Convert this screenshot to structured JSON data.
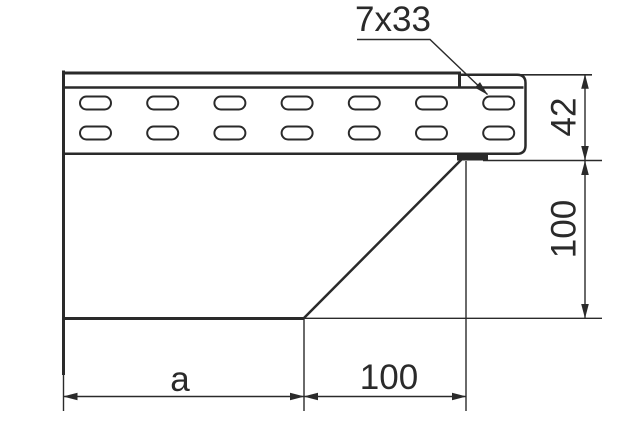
{
  "drawing": {
    "callout": {
      "label": "7x33"
    },
    "dimensions": {
      "rail_height": "42",
      "body_height": "100",
      "bottom_left": "a",
      "bottom_right": "100"
    },
    "slots": {
      "rows": 2,
      "cols": 7
    },
    "colors": {
      "line": "#2a2a2a",
      "background": "#ffffff"
    }
  }
}
